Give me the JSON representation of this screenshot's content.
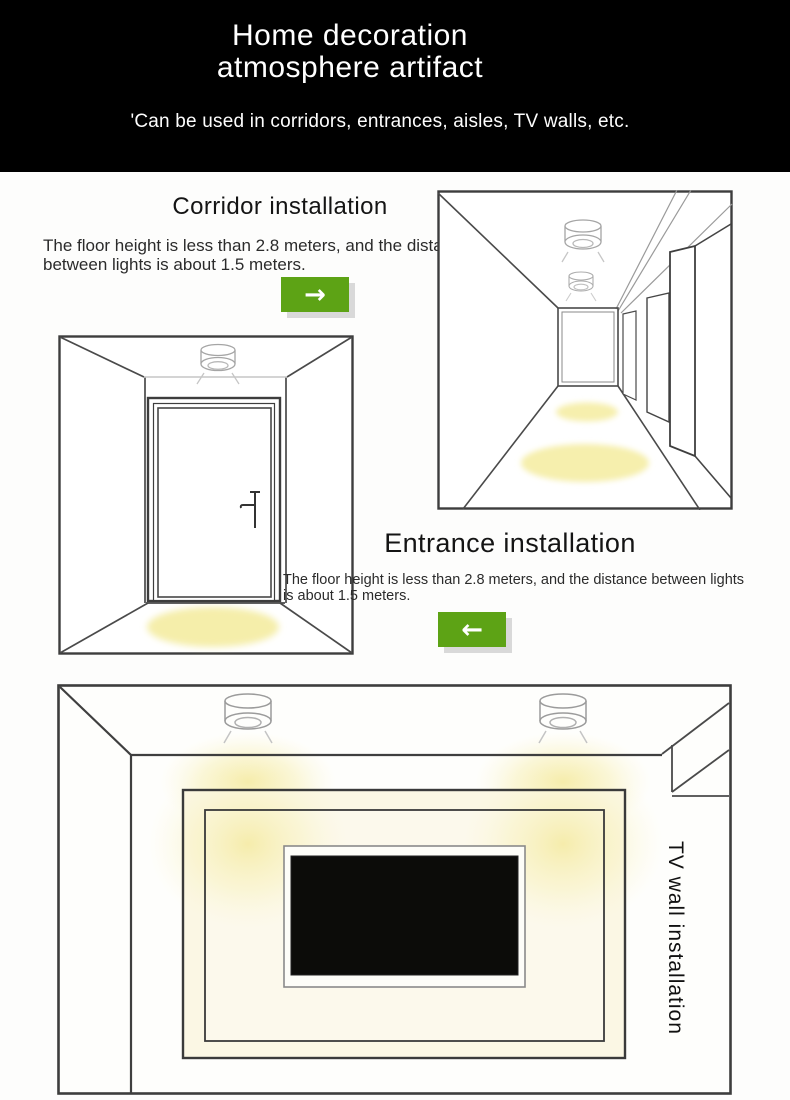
{
  "header": {
    "title_line1": "Home decoration",
    "title_line2": "atmosphere artifact",
    "subtitle": "'Can be used in corridors, entrances, aisles, TV walls, etc."
  },
  "sections": {
    "corridor": {
      "heading": "Corridor installation",
      "body": "The floor height is less than 2.8 meters, and the distance between lights is about 1.5 meters.",
      "arrow_glyph": "→",
      "arrow_icon": "arrow-right-icon"
    },
    "entrance": {
      "heading": "Entrance installation",
      "body": "The floor height is less than 2.8 meters, and the distance between lights is about 1.5 meters.",
      "arrow_glyph": "←",
      "arrow_icon": "arrow-left-icon"
    },
    "tv_wall": {
      "label": "TV wall installation"
    }
  },
  "illustrations": {
    "corridor": "corridor-perspective-line-drawing-with-two-ceiling-downlights-and-floor-light-pools",
    "entrance": "entrance-door-line-drawing-with-ceiling-downlight-and-floor-light-pool",
    "tv_wall": "tv-wall-room-line-drawing-with-two-ceiling-downlights-and-glowing-tv-niche"
  },
  "colors": {
    "header_bg": "#000000",
    "accent_green": "#5da315",
    "button_shadow": "#d9d9d9",
    "light_pool_yellow": "#f6efad",
    "glow_yellow": "#f6eca0",
    "line_dark": "#3d3d3d",
    "line_light": "#a5a5a5"
  }
}
